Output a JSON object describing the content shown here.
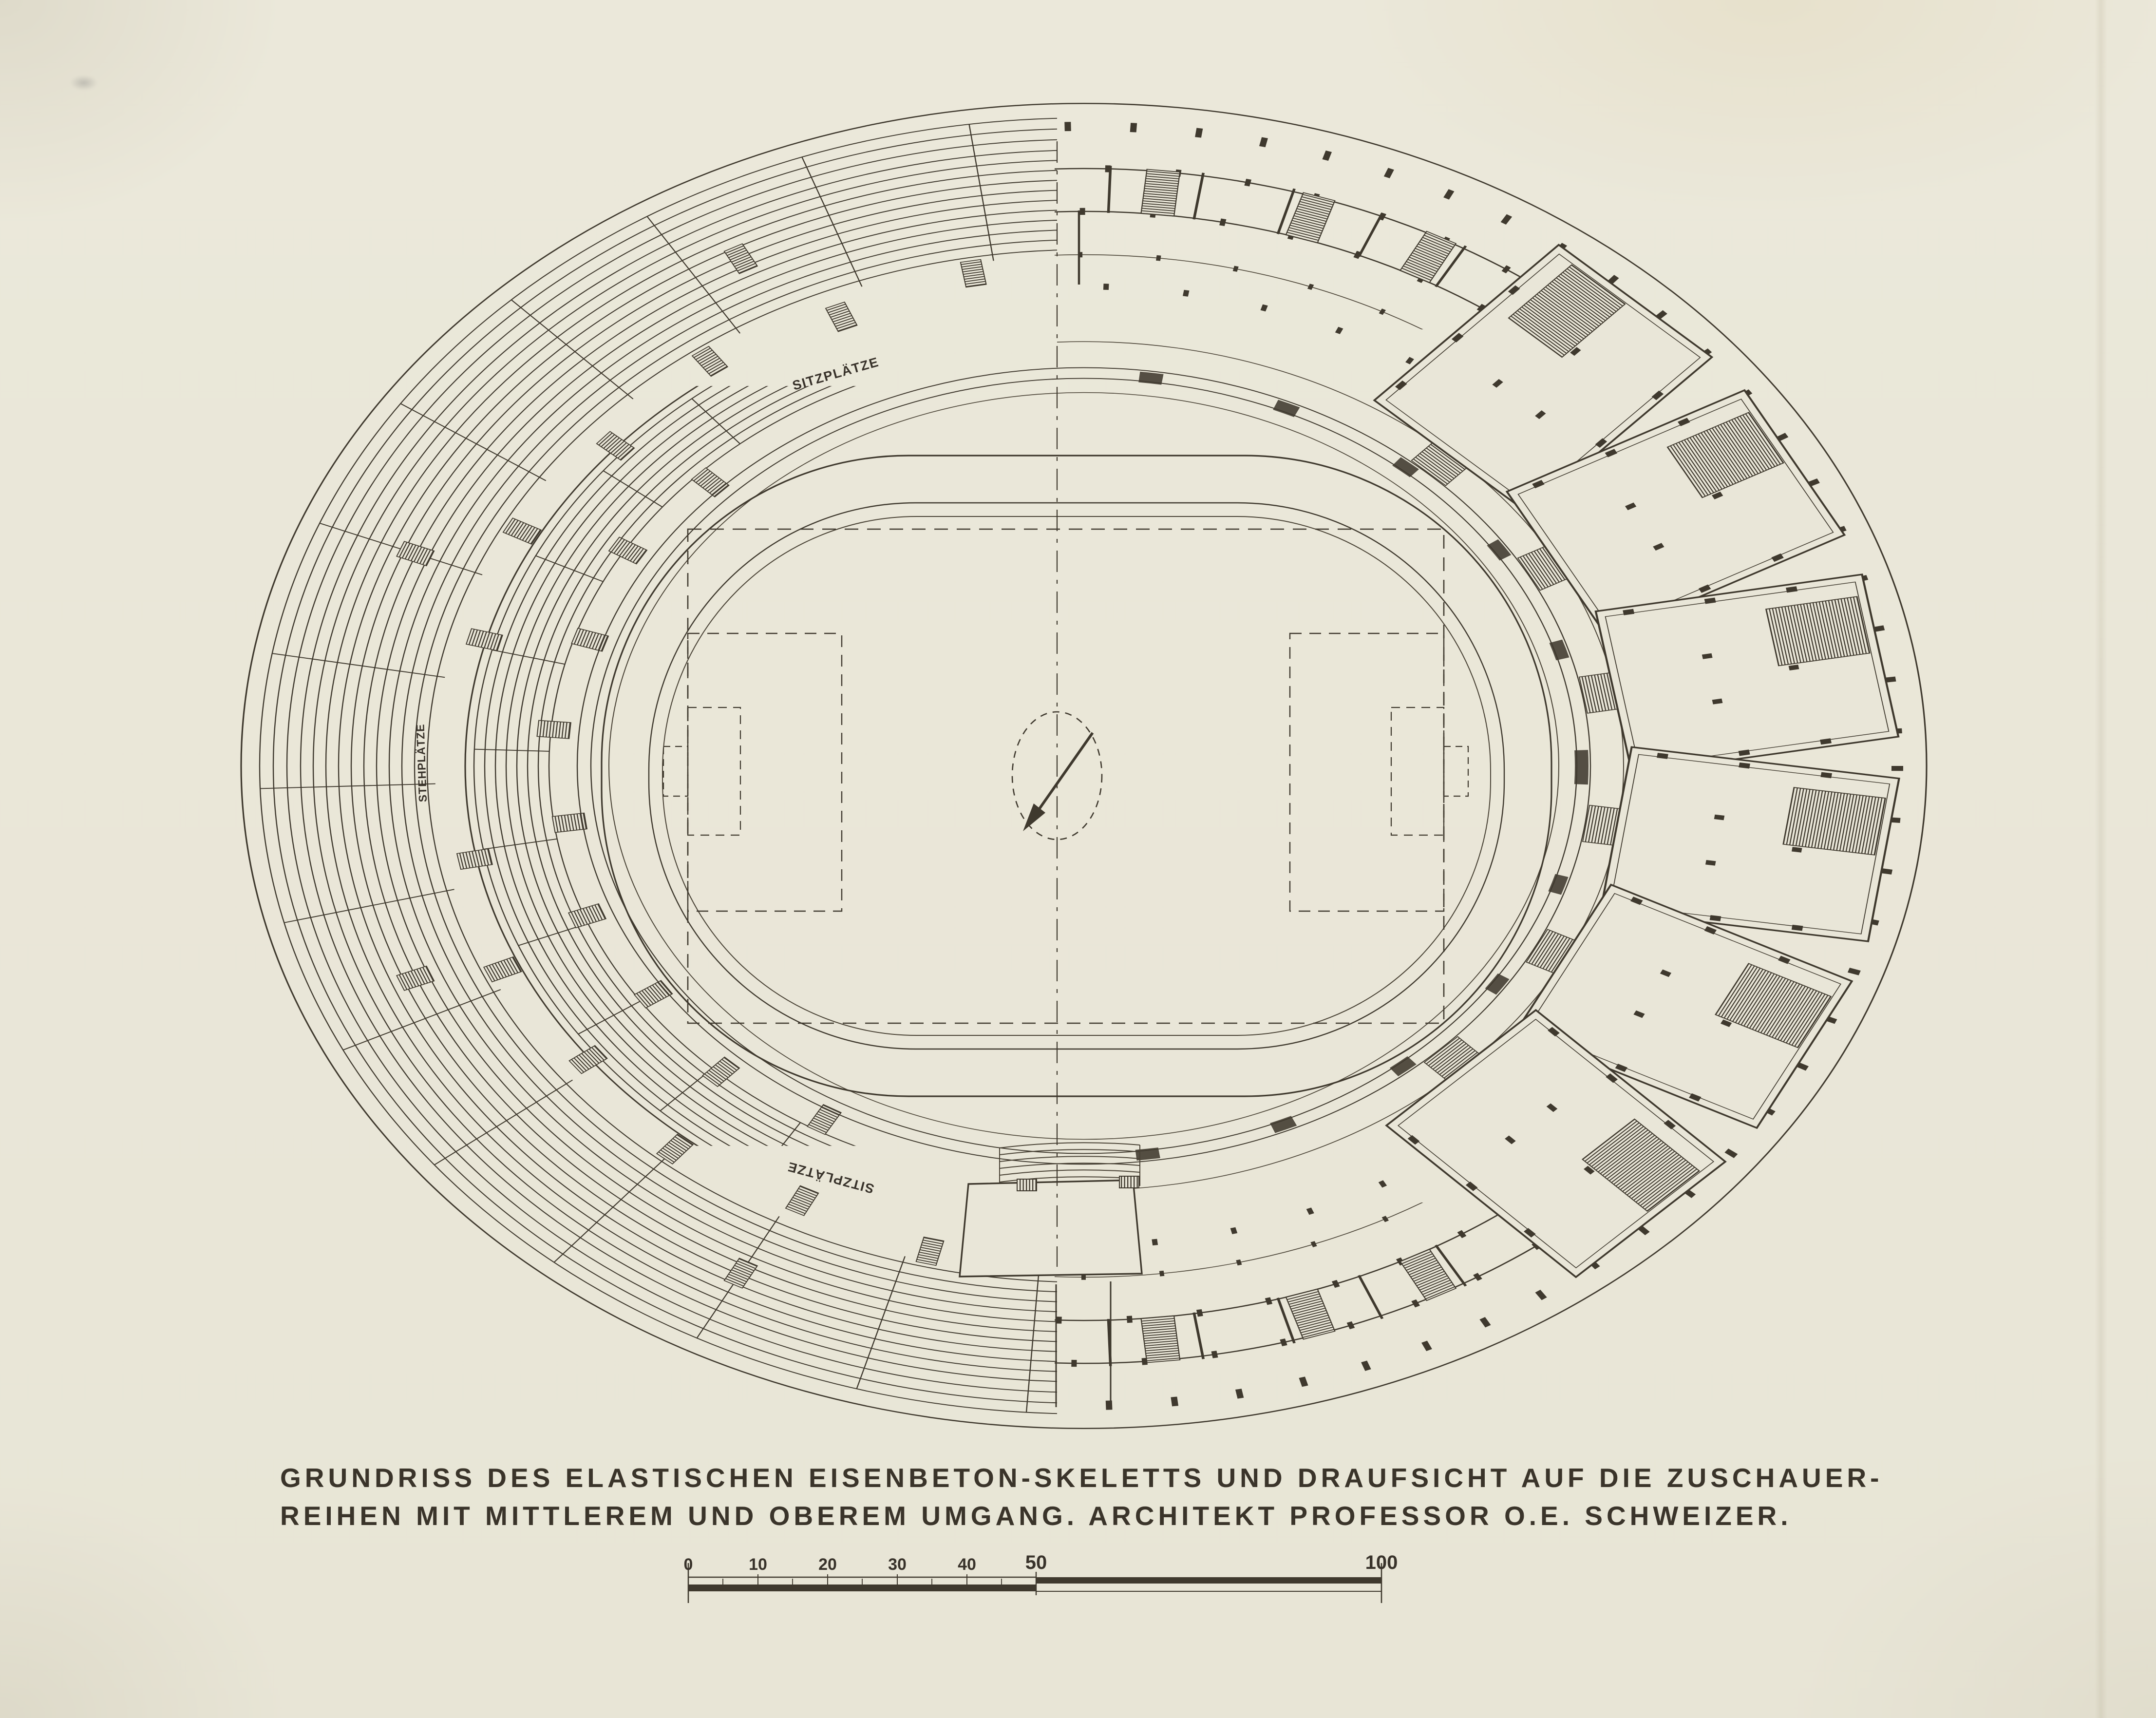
{
  "document": {
    "kind": "scanned architectural plan drawing",
    "colors": {
      "paper": "#e9e6d8",
      "ink": "#3f392e"
    }
  },
  "plan": {
    "labels": {
      "top_seats": "SITZPLÄTZE",
      "left_standing": "STEHPLÄTZE",
      "bottom_seats": "SITZPLÄTZE"
    }
  },
  "caption": {
    "line1": "GRUNDRISS DES ELASTISCHEN EISENBETON-SKELETTS UND DRAUFSICHT AUF DIE ZUSCHAUER-",
    "line2": "REIHEN MIT MITTLEREM UND OBEREM UMGANG. ARCHITEKT PROFESSOR O.E. SCHWEIZER."
  },
  "scale_bar": {
    "ticks": [
      "0",
      "10",
      "20",
      "30",
      "40",
      "50",
      "100"
    ]
  }
}
